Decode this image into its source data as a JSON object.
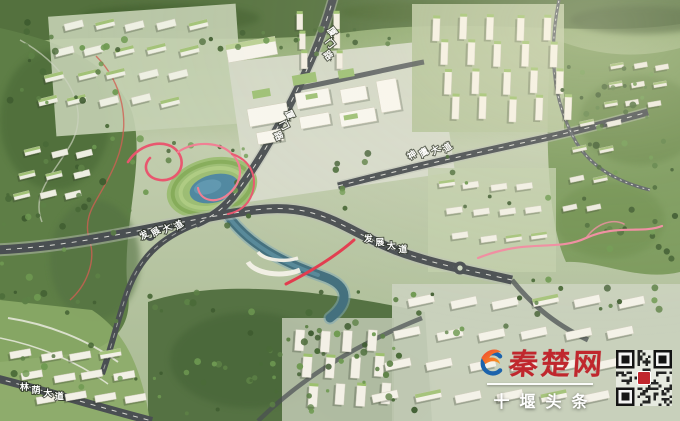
{
  "scene": {
    "description": "Aerial bird's-eye rendering of an urban masterplan with forested hills, a central river and lake with red ribbon walkways, white tower clusters and labeled avenues",
    "road_labels": [
      {
        "id": "xiamen-road-upper",
        "text": "厦门路"
      },
      {
        "id": "xiamen-road-lower",
        "text": "厦门路"
      },
      {
        "id": "shenying-avenue",
        "text": "神鹰大道"
      },
      {
        "id": "fazhan-avenue-west",
        "text": "发展大道"
      },
      {
        "id": "fazhan-avenue-east",
        "text": "发展大道"
      },
      {
        "id": "linyin-avenue",
        "text": "林荫大道"
      }
    ]
  },
  "watermark": {
    "site_name": "秦楚网",
    "channel_name": "十堰头条",
    "logo_icon": "qinchu-swirl-icon",
    "qr_icon": "qr-code",
    "colors": {
      "site_name_red": "#c0272d",
      "channel_text": "#ffffff",
      "logo_blue": "#1c63ac",
      "logo_orange": "#f9a01b",
      "ribbon_red": "#e84a5f",
      "water_teal": "#4f87a0"
    }
  }
}
